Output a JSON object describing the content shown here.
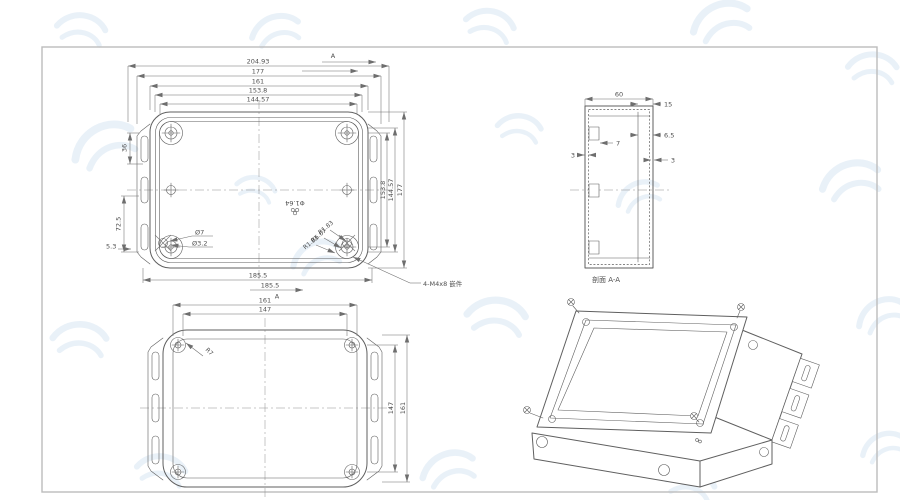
{
  "drawing": {
    "colors": {
      "line": "#5f5f5f",
      "dim": "#6e6e6e",
      "frame": "#bcbcbc",
      "watermark": "#d8e6f3"
    },
    "views": {
      "top": {
        "dims_top": [
          "204.93",
          "177",
          "161",
          "153.8",
          "144.57"
        ],
        "dim_left_upper": "36",
        "dim_left_lower": "72.5",
        "dim_left_small": "5.3",
        "dims_right": [
          "153.8",
          "144.57",
          "177"
        ],
        "dim_bottom": "185.5",
        "hole_callout_outer": "Ø7",
        "hole_callout_inner": "Ø3.2",
        "radius_callouts": [
          "R1.83",
          "R6.67",
          "R1.83"
        ],
        "center_callout": "Φ1.64",
        "insert_callout": "4-M4x8 嵌件",
        "section_letter": "A",
        "section_dim": "185.5"
      },
      "section": {
        "title": "剖面 A-A",
        "dim_width": "60",
        "dim_lip": "15",
        "dim_notch": "7",
        "dim_step": "6.5",
        "dim_wall_left": "3",
        "dim_wall_right": "3"
      },
      "bottom": {
        "dim_top_outer": "161",
        "dim_top_inner": "147",
        "dim_right_inner": "147",
        "dim_right_outer": "161",
        "radius_callout": "R7"
      }
    }
  }
}
